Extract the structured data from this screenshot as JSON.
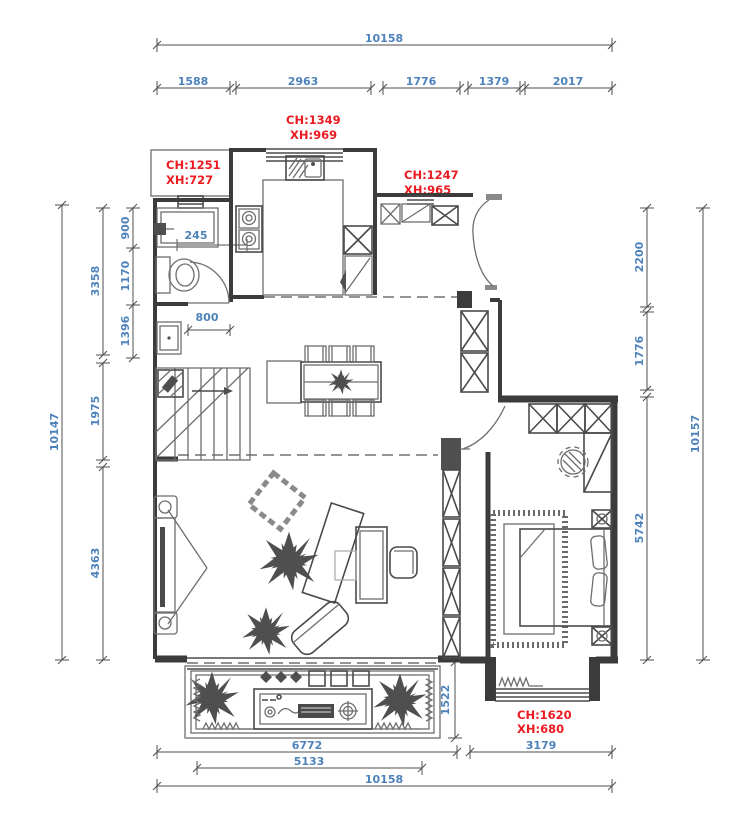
{
  "colors": {
    "dimension_text": "#4e82bb",
    "annotation_text": "#ec1a21",
    "walls": "#3b3b3b",
    "furniture": "#6e6e6e",
    "background": "#ffffff"
  },
  "dims": {
    "top_overall": "10158",
    "top_segments": [
      "1588",
      "2963",
      "1776",
      "1379",
      "2017"
    ],
    "left_outer": "10147",
    "left_mid": [
      "3358",
      "1975",
      "4363"
    ],
    "left_inner": [
      "900",
      "1170",
      "1396"
    ],
    "right_inner": [
      "2200",
      "1776",
      "5742"
    ],
    "right_outer": "10157",
    "bottom_upper": [
      "6772",
      "3179"
    ],
    "bottom_mid": "5133",
    "bottom_overall": "10158",
    "balcony_height": "1522",
    "shower_width": "245",
    "door_width": "800"
  },
  "annotations": {
    "bathroom": {
      "ch": "CH:1251",
      "xh": "XH:727"
    },
    "kitchen": {
      "ch": "CH:1349",
      "xh": "XH:969"
    },
    "entry": {
      "ch": "CH:1247",
      "xh": "XH:965"
    },
    "bay": {
      "ch": "CH:1620",
      "xh": "XH:680"
    }
  }
}
